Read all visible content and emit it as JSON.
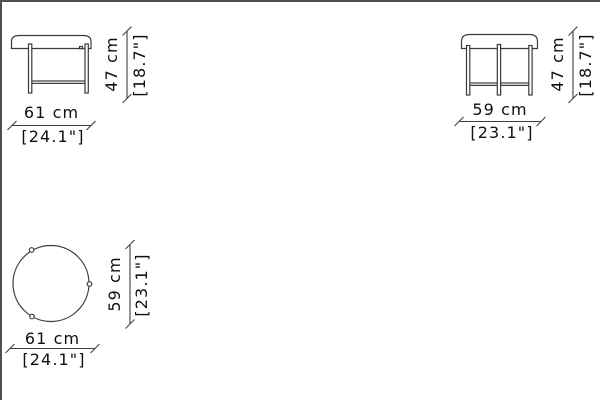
{
  "sheet": {
    "background": "#ffffff",
    "frame_color": "#505050",
    "drawing_line_color": "#3b3b3b",
    "dimension_line_color": "#3e3e3e",
    "text_color": "#101010"
  },
  "views": {
    "front": {
      "width": {
        "metric": "61 cm",
        "imperial": "[24.1\"]"
      },
      "height": {
        "metric": "47 cm",
        "imperial": "[18.7\"]"
      }
    },
    "side": {
      "width": {
        "metric": "59 cm",
        "imperial": "[23.1\"]"
      },
      "height": {
        "metric": "47 cm",
        "imperial": "[18.7\"]"
      }
    },
    "top": {
      "width": {
        "metric": "61 cm",
        "imperial": "[24.1\"]"
      },
      "depth": {
        "metric": "59 cm",
        "imperial": "[23.1\"]"
      }
    }
  }
}
